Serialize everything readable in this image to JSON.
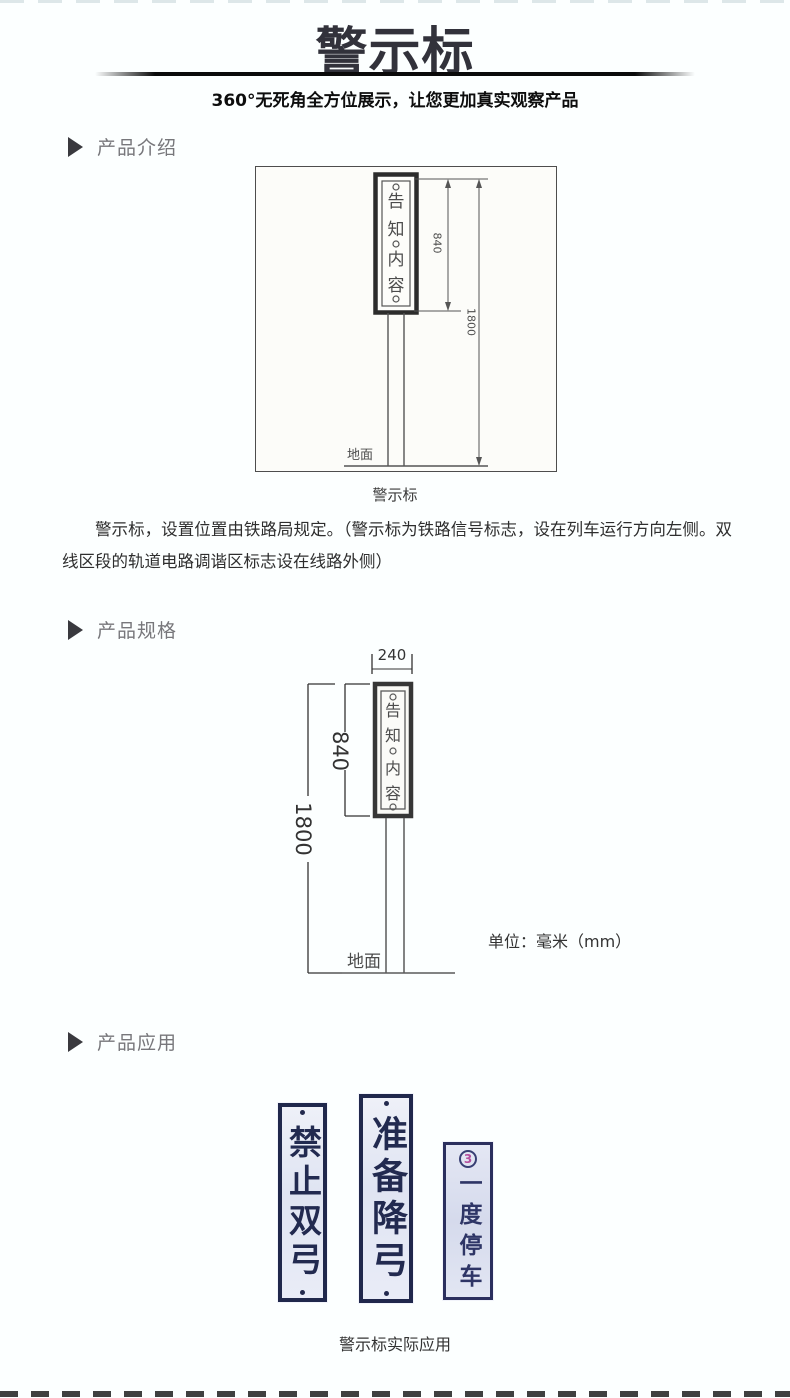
{
  "header": {
    "title": "警示标",
    "subtitle": "360°无死角全方位展示，让您更加真实观察产品"
  },
  "sections": {
    "intro_label": "产品介绍",
    "spec_label": "产品规格",
    "app_label": "产品应用"
  },
  "intro": {
    "diagram": {
      "sign_chars": [
        "告",
        "知",
        "内",
        "容"
      ],
      "sign_height_mm": "840",
      "total_height_mm": "1800",
      "ground_label": "地面"
    },
    "caption": "警示标",
    "paragraph": "警示标，设置位置由铁路局规定。（警示标为铁路信号标志，设在列车运行方向左侧。双线区段的轨道电路调谐区标志设在线路外侧）"
  },
  "spec": {
    "diagram": {
      "width_mm": "240",
      "sign_height_mm": "840",
      "total_height_mm": "1800",
      "sign_chars": [
        "告",
        "知",
        "内",
        "容"
      ],
      "ground_label": "地面"
    },
    "unit_label": "单位：毫米（mm）"
  },
  "application": {
    "signs": [
      {
        "text": "禁止双弓"
      },
      {
        "text": "准备降弓"
      },
      {
        "text": "一度停车",
        "badge": "3"
      }
    ],
    "caption": "警示标实际应用"
  },
  "colors": {
    "title_ink": "#32323b",
    "section_label": "#77777b",
    "drawing_ink": "#4c4c4c",
    "sign_navy": "#222a50",
    "sign_bg": "#e3e7f4",
    "badge_pink": "#b44f9e"
  }
}
